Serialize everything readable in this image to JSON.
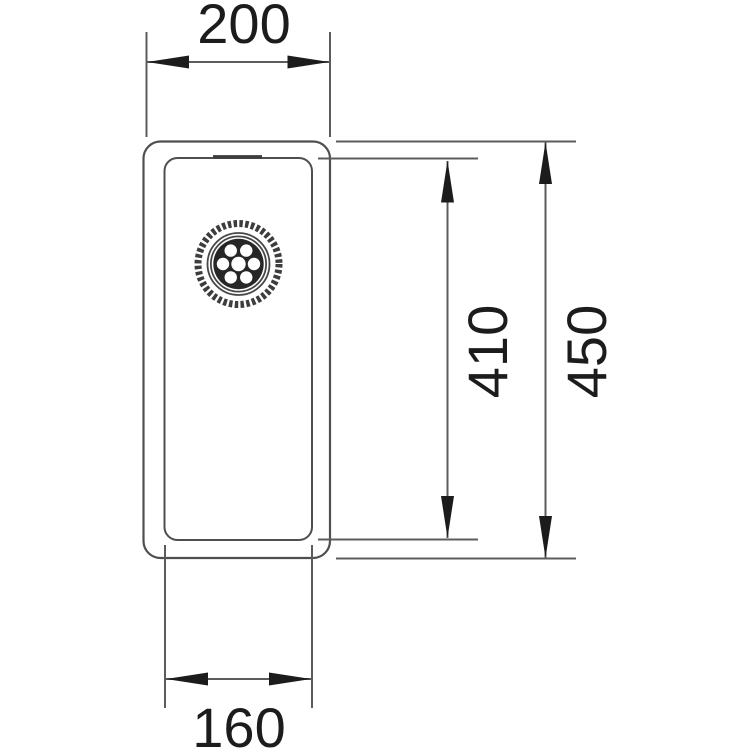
{
  "drawing": {
    "kind": "technical-drawing",
    "subject": "rectangular-sink-top-view-with-drain",
    "background": "#ffffff",
    "colors": {
      "outline": "#4f4f4f",
      "dimension_line": "#5c5c5c",
      "arrow": "#1c1c1c",
      "text": "#1c1c1c",
      "drain": "#262626"
    },
    "dimensions": {
      "outer_width_top": {
        "value": "200"
      },
      "inner_depth_right": {
        "value": "410"
      },
      "outer_depth_right": {
        "value": "450"
      },
      "inner_width_bottom": {
        "value": "160"
      }
    }
  }
}
